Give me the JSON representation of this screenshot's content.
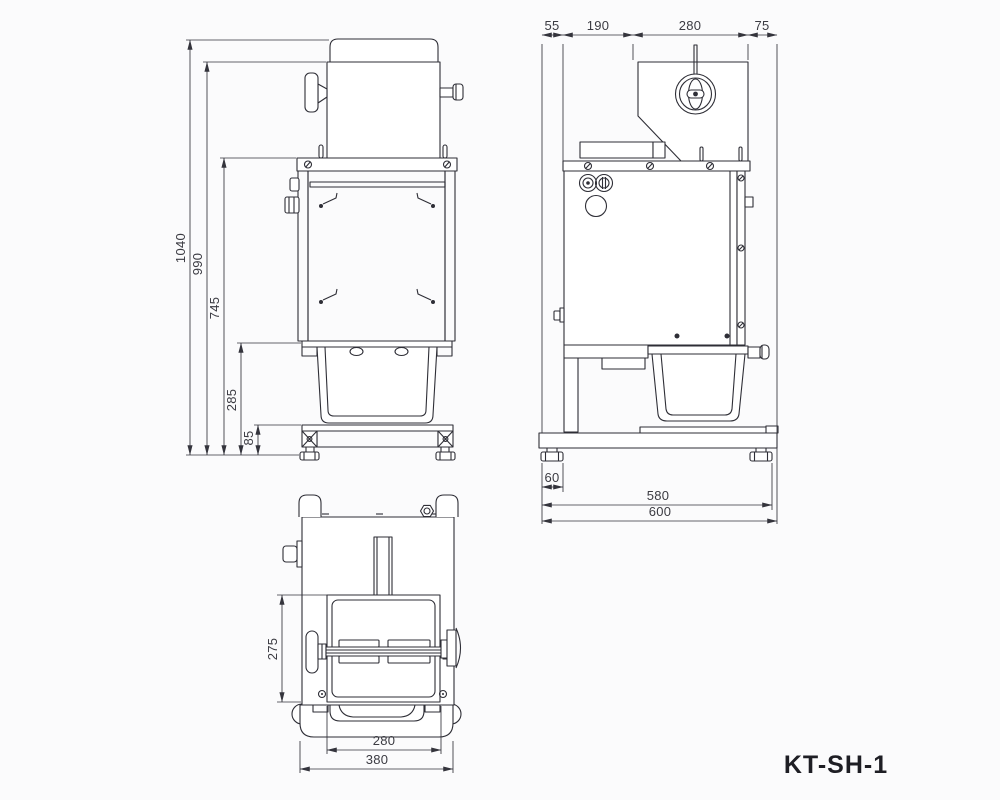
{
  "style": {
    "background": "#fbfbfc",
    "line_color": "#2e2e36",
    "dim_text_color": "#3b3b42",
    "label_color": "#1e1e24"
  },
  "model_label": "KT-SH-1",
  "front_view": {
    "dims": {
      "total_height": "1040",
      "body_height": "990",
      "frame_height": "745",
      "bin_height": "285",
      "base_height": "85"
    }
  },
  "side_view": {
    "dims_top": {
      "seg1": "55",
      "seg2": "190",
      "seg3": "280",
      "seg4": "75"
    },
    "dims_bottom": {
      "foot_width": "60",
      "feet_span": "580",
      "base_length": "600"
    }
  },
  "top_view": {
    "dims": {
      "door_depth": "275",
      "door_width": "280",
      "base_width": "380"
    }
  }
}
